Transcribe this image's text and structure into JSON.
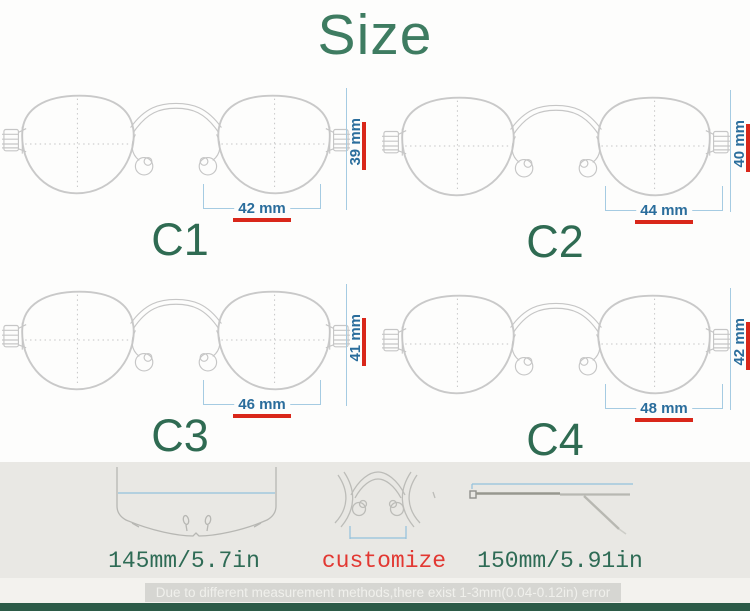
{
  "title": "Size",
  "variants": [
    {
      "label": "C1",
      "lens_width": "42 mm",
      "lens_height": "39 mm"
    },
    {
      "label": "C2",
      "lens_width": "44 mm",
      "lens_height": "40 mm"
    },
    {
      "label": "C3",
      "lens_width": "46 mm",
      "lens_height": "41 mm"
    },
    {
      "label": "C4",
      "lens_width": "48 mm",
      "lens_height": "42 mm"
    }
  ],
  "bottom": {
    "frame_front_length": "145mm/5.7in",
    "nose_bridge": "customize",
    "temple_length": "150mm/5.91in"
  },
  "footer": {
    "disclaimer": "Due to different measurement methods,there exist 1-3mm(0.04-0.12in) error"
  },
  "colors": {
    "heading_green": "#3e7c61",
    "label_green": "#2f6b52",
    "measure_blue": "#2a6d9c",
    "accent_red": "#d9271a",
    "customize_red": "#e23832",
    "dim_line_blue": "#a5cbe2",
    "footer_bar_green": "#2c5b48"
  }
}
